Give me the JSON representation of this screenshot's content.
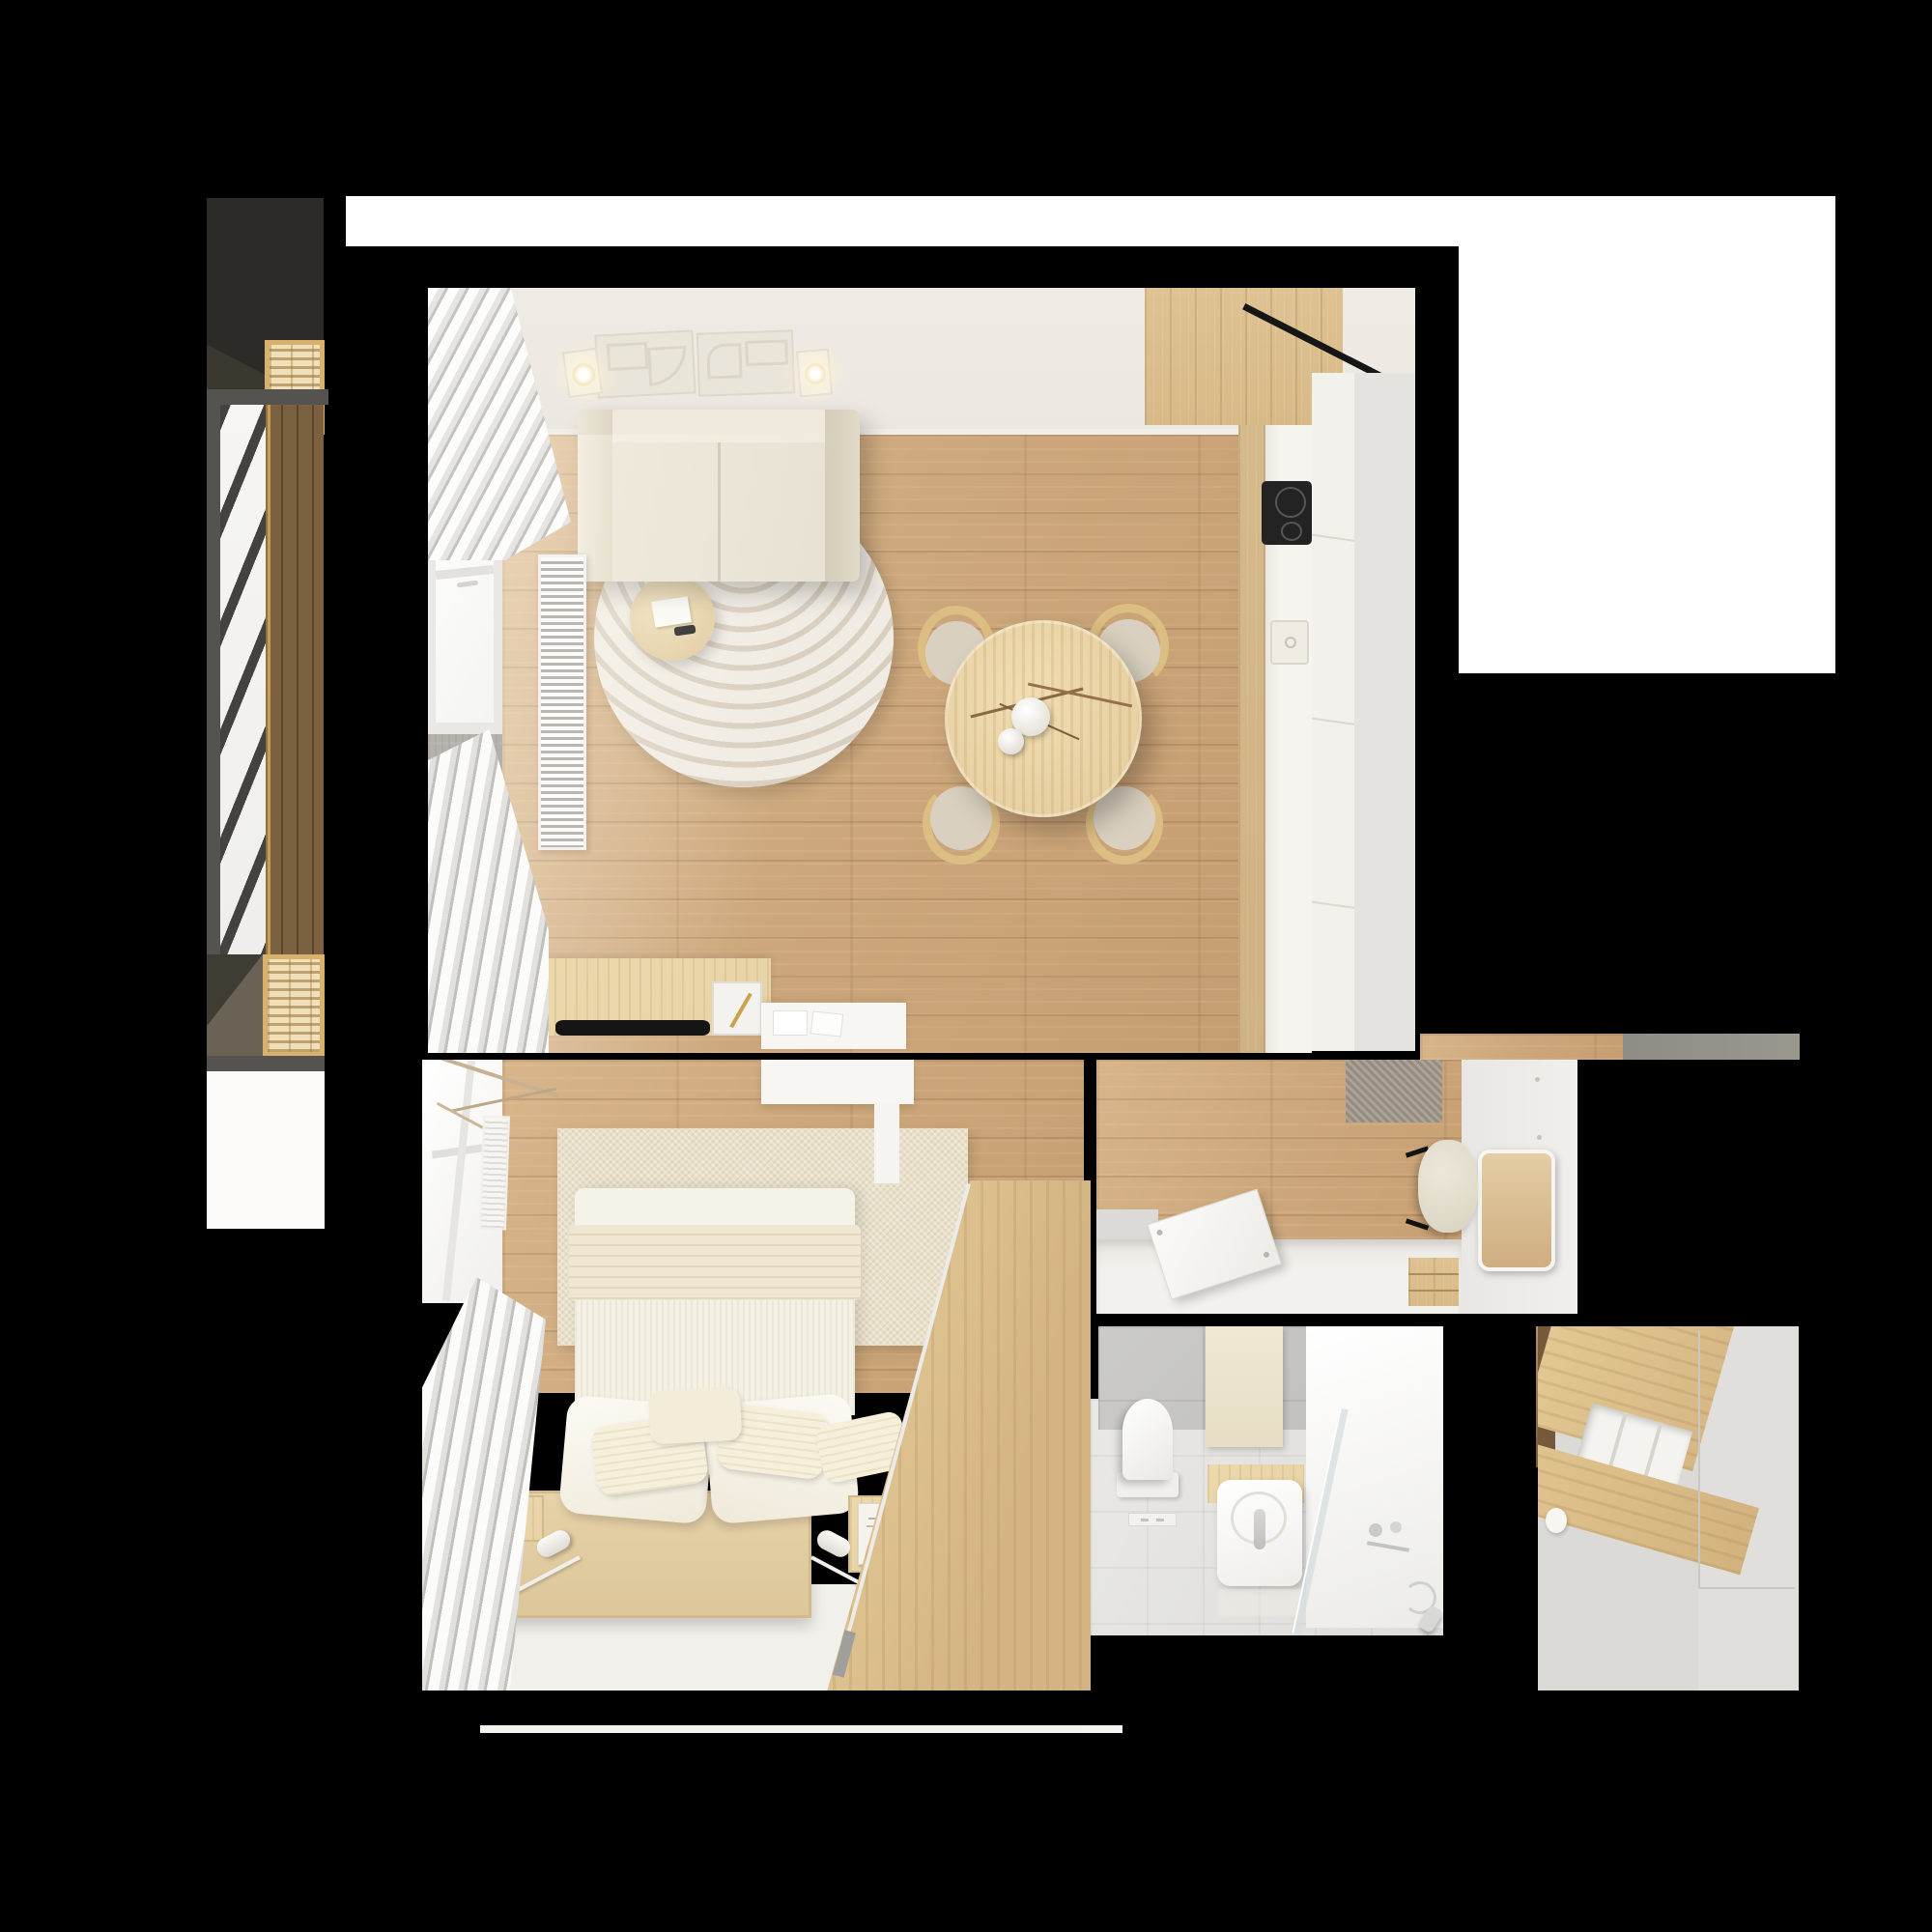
{
  "scene": {
    "type": "3d-floor-plan-render",
    "description": "Top-down photorealistic 3D render of a one-bedroom apartment with balcony on a black background",
    "background": "#000000"
  },
  "palette": {
    "background": "#000000",
    "white": "#ffffff",
    "wall_white": "#ece8e1",
    "floor_white": "#f2f0eb",
    "wood_floor": "#cda87c",
    "wood_cabinet": "#d8ba88",
    "wood_pale": "#e8d3a6",
    "concrete": "#b7b4ae",
    "charcoal": "#2c2b28",
    "rail_gray": "#55534f",
    "gold": "#d8b26c",
    "gold_fill": "#f0e0ba",
    "deck_brown": "#7b613f",
    "sofa_cream": "#e7e2d3",
    "rug_white": "#f0ece4",
    "rug_line": "#d8cfc1",
    "bedroom_rug": "#e9e0ca",
    "textile_white": "#f7f4ec",
    "tile_gray": "#c8c7c4",
    "tan_shadow": "#6a6254",
    "cooktop_black": "#232323"
  },
  "rooms": [
    {
      "id": "balcony",
      "label": "Balcony",
      "features": [
        "metal railing",
        "wood deck",
        "slatted planter boxes"
      ]
    },
    {
      "id": "living-room",
      "label": "Living room with kitchen",
      "features": [
        "sofa",
        "round rug",
        "coffee table",
        "round dining table",
        "four chairs",
        "sideboard",
        "desk",
        "kitchen counter",
        "induction cooktop",
        "sink",
        "radiator grille",
        "roman curtains",
        "ceiling art panels",
        "spotlights"
      ]
    },
    {
      "id": "bedroom",
      "label": "Bedroom",
      "features": [
        "platform bed",
        "pillows",
        "reading lamps",
        "bedside tray with book",
        "area rug",
        "wardrobe",
        "curtains",
        "radiator",
        "tv cabinet"
      ]
    },
    {
      "id": "hallway",
      "label": "Hallway",
      "features": [
        "doormat",
        "pouf",
        "wall mirror",
        "storage bench",
        "open cabinet door",
        "drawer unit"
      ]
    },
    {
      "id": "bathroom",
      "label": "Bathroom",
      "features": [
        "toilet",
        "flush plate",
        "vanity sink",
        "glass shower screen",
        "shower fixtures",
        "hand shower",
        "towel"
      ]
    },
    {
      "id": "closet",
      "label": "Walk-in closet",
      "features": [
        "sliding wardrobe",
        "shelf niche"
      ]
    }
  ]
}
